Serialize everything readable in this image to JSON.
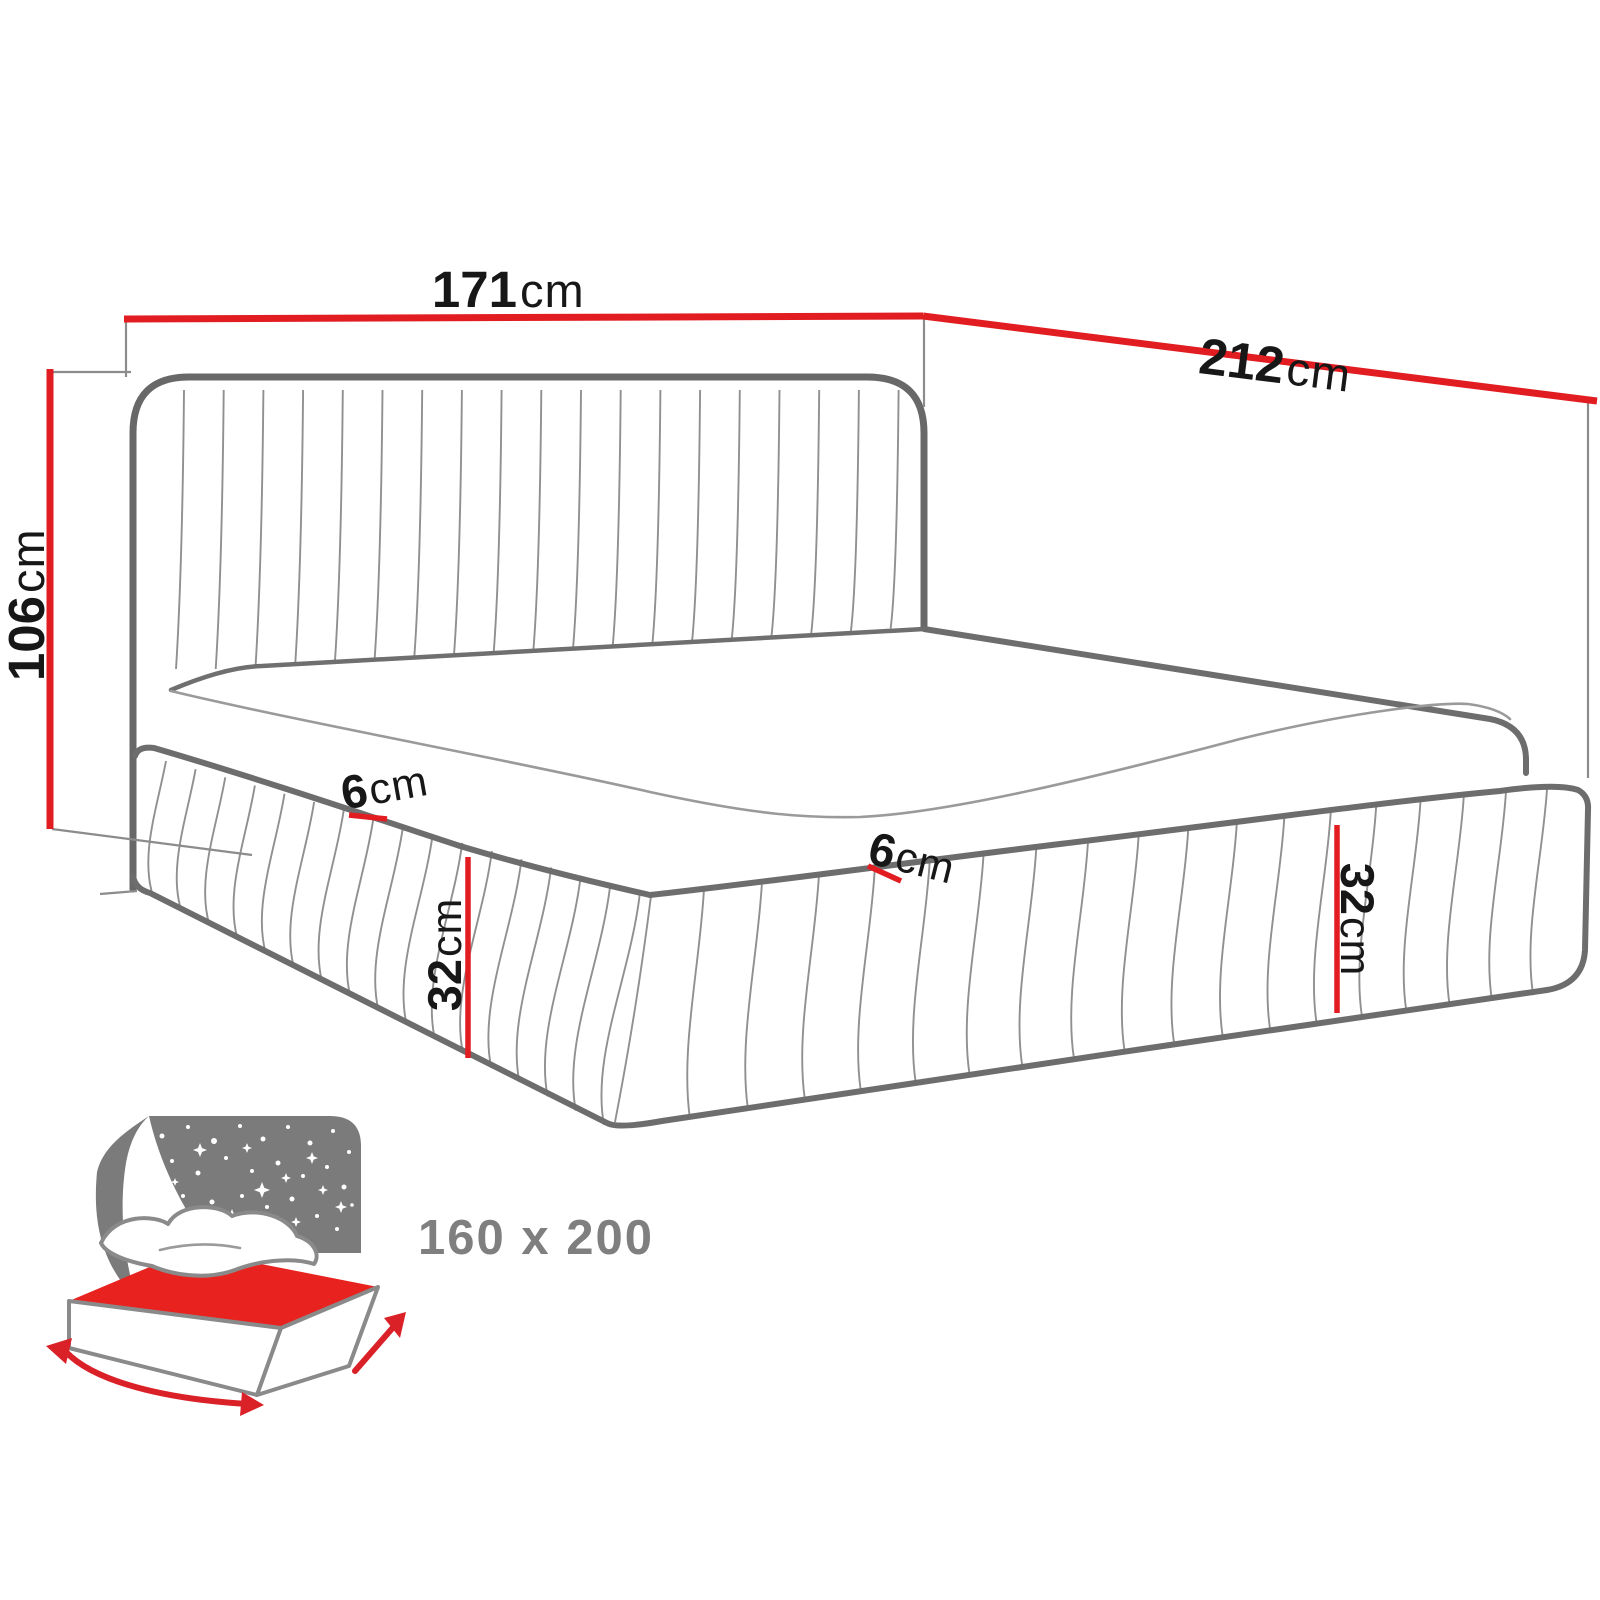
{
  "diagram": {
    "type": "bed-dimension-diagram",
    "dimensions": {
      "width": {
        "value": "171",
        "unit": "cm"
      },
      "length": {
        "value": "212",
        "unit": "cm"
      },
      "height": {
        "value": "106",
        "unit": "cm"
      },
      "frame_gap_left": {
        "value": "6",
        "unit": "cm"
      },
      "frame_gap_right": {
        "value": "6",
        "unit": "cm"
      },
      "frame_height_left": {
        "value": "32",
        "unit": "cm"
      },
      "frame_height_right": {
        "value": "32",
        "unit": "cm"
      }
    },
    "mattress_size": {
      "label": "160 x 200"
    },
    "colors": {
      "dimension_red": "#e21d22",
      "outline_gray": "#686868",
      "line_gray": "#9a9a9a",
      "icon_gray": "#7b7b7b",
      "label_black": "#171717",
      "size_label_gray": "#7f7f7f"
    }
  }
}
